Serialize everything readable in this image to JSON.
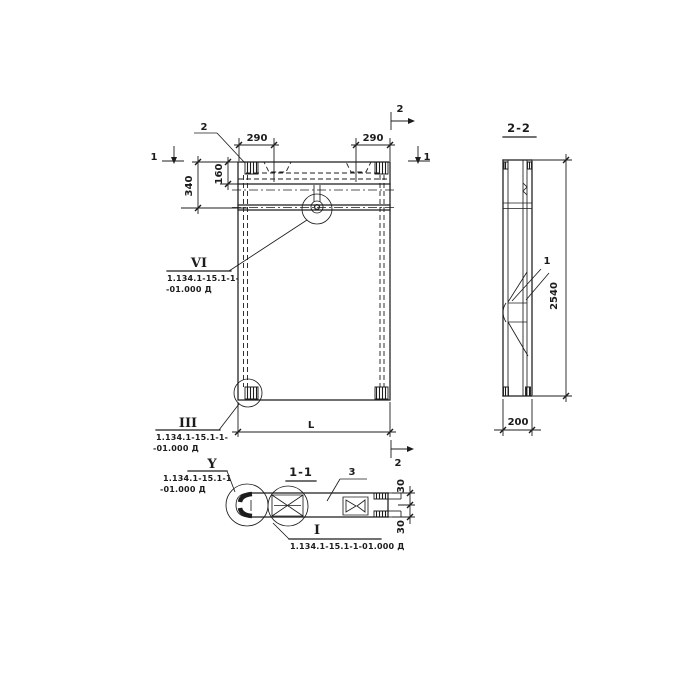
{
  "colors": {
    "ink": "#1c1c1c",
    "paper": "#ffffff"
  },
  "elevation": {
    "callout_2_top": "2",
    "marker_1_left": "1",
    "marker_1_right": "1",
    "marker_2_right_top": "2",
    "marker_2_right_bottom": "2",
    "dim_290_left": "290",
    "dim_290_right": "290",
    "dim_340": "340",
    "dim_160": "160",
    "dim_L": "L",
    "detail_vi": {
      "numeral": "VI",
      "ref1": "1.134.1-15.1-1-",
      "ref2": "-01.000 Д"
    },
    "detail_iii": {
      "numeral": "III",
      "ref1": "1.134.1-15.1-1-",
      "ref2": "-01.000 Д"
    }
  },
  "section22": {
    "title": "2-2",
    "dim_2540": "2540",
    "dim_200": "200",
    "callout_1": "1"
  },
  "section11": {
    "title": "1-1",
    "callout_3": "3",
    "dim_30_top": "30",
    "dim_30_bottom": "30",
    "detail_y": {
      "numeral": "Y",
      "ref1": "1.134.1-15.1-1",
      "ref2": "-01.000 Д"
    },
    "detail_i": {
      "numeral": "I",
      "ref1": "1.134.1-15.1-1-01.000 Д"
    }
  }
}
